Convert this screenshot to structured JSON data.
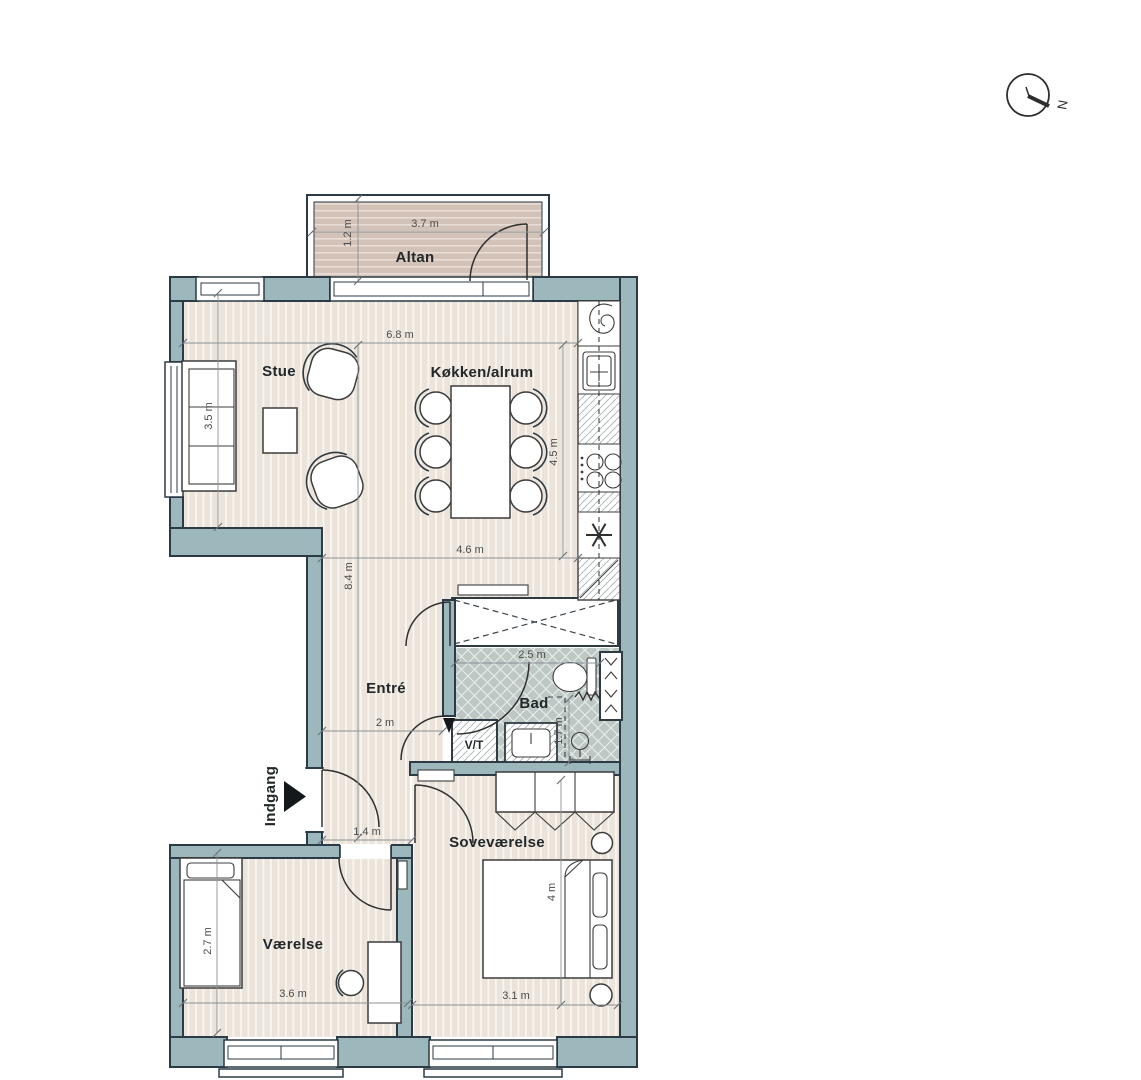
{
  "rooms": {
    "altan": "Altan",
    "stue": "Stue",
    "kokken": "Køkken/alrum",
    "entre": "Entré",
    "bad": "Bad",
    "vt": "V/T",
    "sove": "Soveværelse",
    "vaerelse": "Værelse",
    "indgang": "Indgang"
  },
  "compass": {
    "north": "N"
  },
  "dims": {
    "altan_w": "3.7 m",
    "altan_d": "1.2 m",
    "living_w": "6.8 m",
    "stue_d": "3.5 m",
    "kokken_d": "4.5 m",
    "kokken_w": "4.6 m",
    "entre_l": "8.4 m",
    "entre_w": "2 m",
    "bad_w": "2.5 m",
    "bad_d": "1.7 m",
    "hall_w": "1.4 m",
    "sove_d": "4 m",
    "sove_w": "3.1 m",
    "vaer_d": "2.7 m",
    "vaer_w": "3.6 m"
  },
  "colors": {
    "wall": "#9cb8bc",
    "wall_outline": "#2b3a44",
    "floor": "#ece4db",
    "bad_floor": "#bdc7c4",
    "dim": "#8a9296",
    "text": "#22272a",
    "line": "#3c3c3c"
  }
}
